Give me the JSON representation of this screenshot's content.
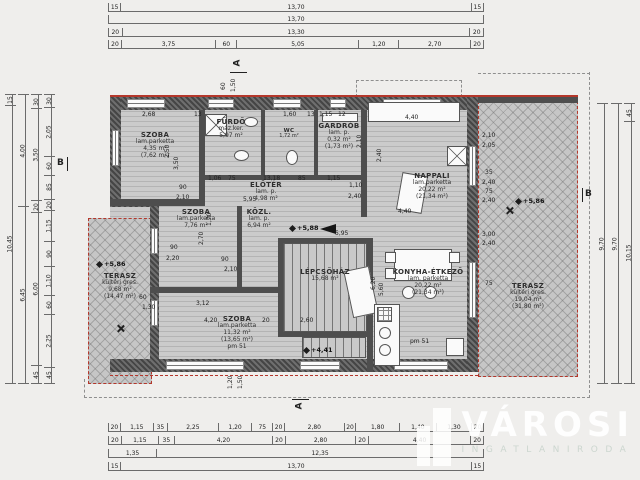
{
  "logo": {
    "name": "VÁROSI",
    "sub": "INGATLANIRODA"
  },
  "sections": {
    "a": "A",
    "b": "B"
  },
  "colors": {
    "roof_red": "#b4372b",
    "wall_dark": "#454545",
    "floor_gray": "#cbcbcb",
    "terrace_gray": "#c6c6c6",
    "background": "#efeeec"
  },
  "rooms": [
    {
      "id": "szoba-1",
      "name": "SZOBA",
      "floor": "lam.parketta",
      "area": "4,35 m²",
      "area_gross": "(7,62 m²)"
    },
    {
      "id": "furdo",
      "name": "FÜRDŐ",
      "floor": "máz.ker.",
      "area": "5,97 m²"
    },
    {
      "id": "wc",
      "name": "WC",
      "area": "1,72 m²"
    },
    {
      "id": "gardrob",
      "name": "GARDRÓB",
      "floor": "lam. p.",
      "area": "0,32 m²",
      "area_gross": "(1,73 m²)"
    },
    {
      "id": "eloter",
      "name": "ELŐTÉR",
      "floor": "lam. p.",
      "area": "4,98 m²"
    },
    {
      "id": "szoba-2",
      "name": "SZOBA",
      "floor": "lam.parketta",
      "area": "7,76 m²"
    },
    {
      "id": "kozl",
      "name": "KÖZL.",
      "floor": "lam. p.",
      "area": "6,94 m²"
    },
    {
      "id": "nappali",
      "name": "NAPPALI",
      "floor": "lam.parketta",
      "area": "20,22 m²",
      "area_gross": "(21,34 m²)"
    },
    {
      "id": "lepcsohaz",
      "name": "LÉPCSŐHÁZ",
      "area": "15,68 m²"
    },
    {
      "id": "konyha-etkezo",
      "name": "KONYHA-ÉTKEZŐ",
      "floor": "lam. parketta",
      "area": "20,22 m²",
      "area_gross": "(21,34 m²)"
    },
    {
      "id": "szoba-3",
      "name": "SZOBA",
      "floor": "lam.parketta",
      "area": "11,32 m²",
      "area_gross": "(13,65 m²)",
      "extra": "pm 51"
    },
    {
      "id": "terasz-left",
      "name": "TERASZ",
      "floor": "kültéri gres.",
      "area": "9,68 m²",
      "area_gross": "(14,47 m²)"
    },
    {
      "id": "terasz-right",
      "name": "TERASZ",
      "floor": "kültéri gres.",
      "area": "19,04 m²",
      "area_gross": "(31,80 m²)"
    }
  ],
  "dims": {
    "top": [
      [
        "15",
        "13,70",
        "15"
      ],
      [
        "13,70"
      ],
      [
        "20",
        "13,30",
        "20"
      ],
      [
        "20",
        "3,75",
        "60",
        "5,05",
        "1,20",
        "2,70",
        "20"
      ]
    ],
    "bottom": [
      [
        "20",
        "1,15",
        "35",
        "2,25",
        "1,20",
        "75",
        "20",
        "2,80",
        "20",
        "1,80",
        "1,40",
        "1,30",
        "20"
      ],
      [
        "20",
        "1,15",
        "35",
        "4,20",
        "20",
        "2,80",
        "20",
        "4,40",
        "20"
      ],
      [
        "1,35",
        "12,35"
      ],
      [
        "15",
        "13,70",
        "15"
      ]
    ],
    "left": [
      [
        "15",
        "10,45"
      ],
      [
        "4,00",
        "6,45"
      ],
      [
        "30",
        "3,50",
        "20",
        "6,00",
        "45"
      ],
      [
        "30",
        "2,05",
        "60",
        "85",
        "20",
        "1,15",
        "90",
        "1,10",
        "60",
        "2,25",
        "45"
      ]
    ],
    "right": [
      [
        "9,70"
      ],
      [
        "9,70"
      ],
      [
        "45",
        "10,15"
      ]
    ]
  },
  "inner_dims": [
    {
      "t": "60",
      "x": 221,
      "y": 90,
      "v": 1
    },
    {
      "t": "1,50",
      "x": 231,
      "y": 92,
      "v": 1
    },
    {
      "t": "2,68",
      "x": 142,
      "y": 112
    },
    {
      "t": "13",
      "x": 194,
      "y": 112
    },
    {
      "t": "1,60",
      "x": 283,
      "y": 112
    },
    {
      "t": "13",
      "x": 307,
      "y": 112
    },
    {
      "t": "1,15",
      "x": 319,
      "y": 112
    },
    {
      "t": "12",
      "x": 338,
      "y": 112
    },
    {
      "t": "4,40",
      "x": 405,
      "y": 115
    },
    {
      "t": "2,10",
      "x": 357,
      "y": 148,
      "v": 1
    },
    {
      "t": "2,40",
      "x": 377,
      "y": 162,
      "v": 1
    },
    {
      "t": "2,50",
      "x": 165,
      "y": 158,
      "v": 1
    },
    {
      "t": "3,50",
      "x": 174,
      "y": 170,
      "v": 1
    },
    {
      "t": "1,06",
      "x": 208,
      "y": 176
    },
    {
      "t": "75",
      "x": 228,
      "y": 176
    },
    {
      "t": "13,18",
      "x": 263,
      "y": 176
    },
    {
      "t": "85",
      "x": 298,
      "y": 176
    },
    {
      "t": "1,15",
      "x": 327,
      "y": 176
    },
    {
      "t": "1,10",
      "x": 349,
      "y": 183
    },
    {
      "t": "2,40",
      "x": 348,
      "y": 194
    },
    {
      "t": "90",
      "x": 179,
      "y": 185
    },
    {
      "t": "2,10",
      "x": 176,
      "y": 195
    },
    {
      "t": "5,95",
      "x": 243,
      "y": 197
    },
    {
      "t": "1,70",
      "x": 207,
      "y": 226,
      "v": 1
    },
    {
      "t": "2,70",
      "x": 199,
      "y": 245,
      "v": 1
    },
    {
      "t": "90",
      "x": 221,
      "y": 257
    },
    {
      "t": "2,10",
      "x": 224,
      "y": 267
    },
    {
      "t": "90",
      "x": 170,
      "y": 245
    },
    {
      "t": "2,20",
      "x": 166,
      "y": 256
    },
    {
      "t": "5,95",
      "x": 335,
      "y": 231
    },
    {
      "t": "3,12",
      "x": 196,
      "y": 301
    },
    {
      "t": "4,20",
      "x": 204,
      "y": 318
    },
    {
      "t": "20",
      "x": 262,
      "y": 318
    },
    {
      "t": "2,60",
      "x": 300,
      "y": 318
    },
    {
      "t": "6,20",
      "x": 371,
      "y": 290,
      "v": 1
    },
    {
      "t": "5,60",
      "x": 379,
      "y": 296,
      "v": 1
    },
    {
      "t": "4,40",
      "x": 398,
      "y": 209
    },
    {
      "t": "pm 51",
      "x": 410,
      "y": 339
    },
    {
      "t": "60",
      "x": 139,
      "y": 295
    },
    {
      "t": "1,30",
      "x": 142,
      "y": 305
    },
    {
      "t": "1,20",
      "x": 228,
      "y": 389,
      "v": 1
    },
    {
      "t": "1,50",
      "x": 238,
      "y": 389,
      "v": 1
    },
    {
      "t": "2,10",
      "x": 482,
      "y": 133
    },
    {
      "t": "2,05",
      "x": 482,
      "y": 143
    },
    {
      "t": "35",
      "x": 485,
      "y": 170
    },
    {
      "t": "2,40",
      "x": 482,
      "y": 180
    },
    {
      "t": "75",
      "x": 485,
      "y": 189
    },
    {
      "t": "2,40",
      "x": 482,
      "y": 198
    },
    {
      "t": "3,00",
      "x": 482,
      "y": 232
    },
    {
      "t": "2,40",
      "x": 482,
      "y": 241
    },
    {
      "t": "75",
      "x": 485,
      "y": 281
    }
  ],
  "level_marks": [
    {
      "t": "+5,86",
      "x": 97,
      "y": 260
    },
    {
      "t": "+5,86",
      "x": 516,
      "y": 197
    },
    {
      "t": "+5,88",
      "x": 290,
      "y": 224
    },
    {
      "t": "+4,41",
      "x": 304,
      "y": 346
    }
  ]
}
